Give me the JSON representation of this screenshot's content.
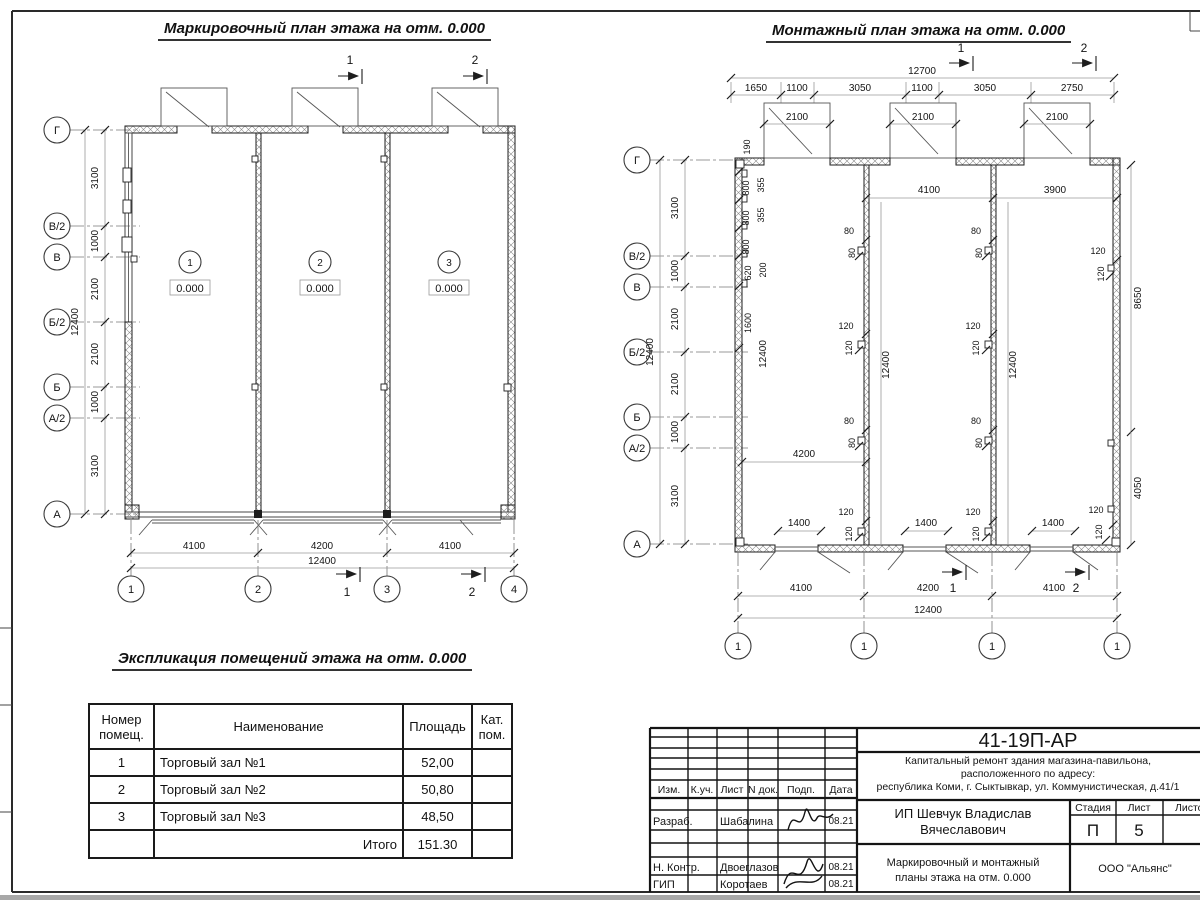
{
  "left_plan": {
    "title": "Маркировочный план этажа на отм. 0.000",
    "section_mark_1": "1",
    "section_mark_2": "2",
    "axes": [
      "Г",
      "В/2",
      "В",
      "Б/2",
      "Б",
      "А/2",
      "А"
    ],
    "row_dims": [
      "3100",
      "1000",
      "2100",
      "2100",
      "1000",
      "3100"
    ],
    "total_dim": "12400",
    "rooms": [
      {
        "num": "1",
        "level": "0.000"
      },
      {
        "num": "2",
        "level": "0.000"
      },
      {
        "num": "3",
        "level": "0.000"
      }
    ],
    "bottom_dims": [
      "4100",
      "4200",
      "4100"
    ],
    "bottom_total": "12400",
    "columns": [
      "1",
      "2",
      "3",
      "4"
    ]
  },
  "right_plan": {
    "title": "Монтажный план этажа на отм. 0.000",
    "section_mark_1": "1",
    "section_mark_2": "2",
    "top_total": "12700",
    "top_dims": [
      "1650",
      "1100",
      "3050",
      "1100",
      "3050",
      "2750"
    ],
    "door_dim": "2100",
    "axes": [
      "Г",
      "В/2",
      "В",
      "Б/2",
      "Б",
      "А/2",
      "А"
    ],
    "row_dims": [
      "3100",
      "1000",
      "2100",
      "2100",
      "1000",
      "3100"
    ],
    "total_dim": "12400",
    "wall_panel_dims": [
      "190",
      "800",
      "355",
      "800",
      "355",
      "800",
      "620",
      "200",
      "1600"
    ],
    "wall_run_dim": "12400",
    "span_dims": {
      "left_top": "4100",
      "right_top": "3900",
      "right_upper": "8650",
      "right_lower": "4050",
      "mid": "4200"
    },
    "stud_dim_80": "80",
    "stud_dim_120": "120",
    "opening_dim": "1400",
    "bottom_dims": [
      "4100",
      "4200",
      "4100"
    ],
    "bottom_total": "12400",
    "node_marks": [
      "1",
      "1",
      "1",
      "1"
    ]
  },
  "table": {
    "title": "Экспликация помещений этажа на отм. 0.000",
    "col_headers": [
      "Номер помещ.",
      "Наименование",
      "Площадь",
      "Кат. пом."
    ],
    "rows": [
      {
        "num": "1",
        "name": "Торговый зал №1",
        "area": "52,00",
        "cat": ""
      },
      {
        "num": "2",
        "name": "Торговый зал №2",
        "area": "50,80",
        "cat": ""
      },
      {
        "num": "3",
        "name": "Торговый зал №3",
        "area": "48,50",
        "cat": ""
      }
    ],
    "total_label": "Итого",
    "total_value": "151.30"
  },
  "title_block": {
    "doc_code": "41-19П-АР",
    "project_desc_line1": "Капитальный ремонт здания магазина-павильона,",
    "project_desc_line2": "расположенного по адресу:",
    "project_desc_line3": "республика Коми, г. Сыктывкар, ул. Коммунистическая, д.41/1",
    "cols": {
      "izm": "Изм.",
      "kuch": "К.уч.",
      "list": "Лист",
      "ndok": "N док.",
      "podp": "Подп.",
      "data": "Дата"
    },
    "rows": [
      {
        "role": "Разраб.",
        "name": "Шабалина",
        "date": "08.21"
      },
      {
        "role": "Н. Контр.",
        "name": "Двоеглазов",
        "date": "08.21"
      },
      {
        "role": "ГИП",
        "name": "Коротаев",
        "date": "08.21"
      }
    ],
    "client_line1": "ИП Шевчук Владислав",
    "client_line2": "Вячеславович",
    "stage_label": "Стадия",
    "sheet_label": "Лист",
    "sheets_label": "Листов",
    "stage_value": "П",
    "sheet_value": "5",
    "sheet_title_line1": "Маркировочный и монтажный",
    "sheet_title_line2": "планы этажа на отм. 0.000",
    "organization": "ООО \"Альянс\""
  }
}
